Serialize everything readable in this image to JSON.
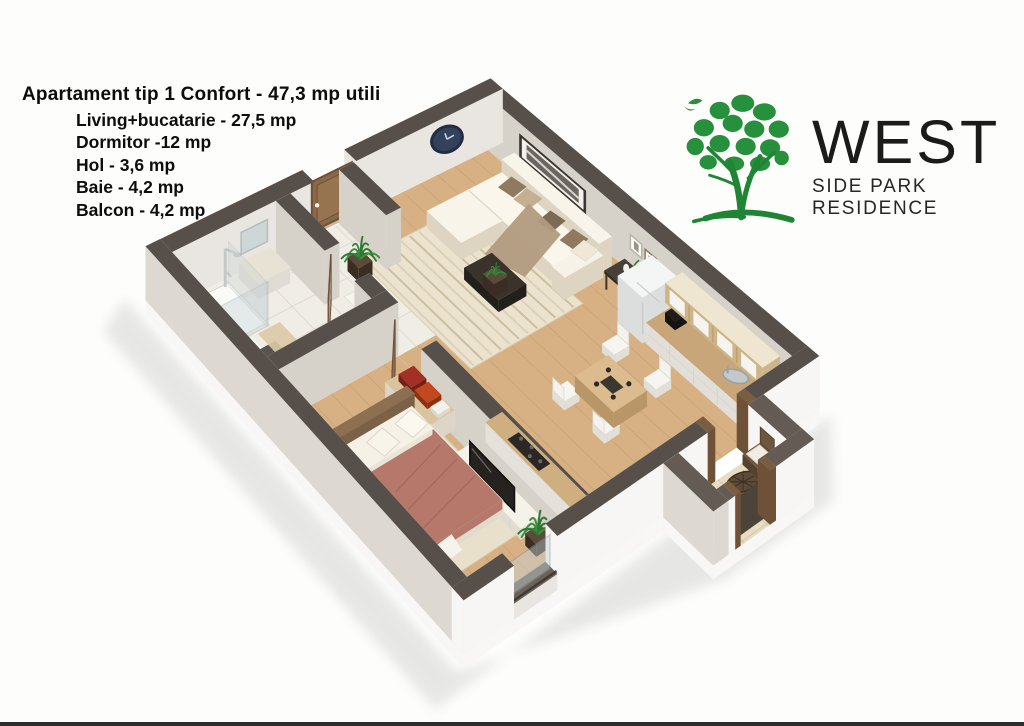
{
  "info": {
    "title": "Apartament tip 1 Confort - 47,3 mp utili",
    "rooms": [
      "Living+bucatarie - 27,5 mp",
      "Dormitor -12 mp",
      "Hol - 3,6 mp",
      "Baie - 4,2 mp",
      "Balcon - 4,2 mp"
    ]
  },
  "logo": {
    "name": "WEST",
    "subtitle": "SIDE PARK RESIDENCE",
    "tree_icon": "tree-logo-icon",
    "green": "#27903c"
  },
  "palette": {
    "wallTop": "#57504a",
    "wallTopLight": "#645c54",
    "wallFace": "#e9e6e1",
    "wallFaceDark": "#d6d2ca",
    "wallExt": "#f7f6f4",
    "slabA": "#efedea",
    "slabB": "#f8f7f5",
    "wood": "#d7b184",
    "woodLine": "#bb9464",
    "tile": "#f0ede7",
    "tileLine": "#dcd7cd",
    "balconyTile": "#e8dcc4",
    "balconyTileLine": "#d2c3a3",
    "rug": "#ece3cf",
    "rugStripe": "#c9bb9c",
    "sofa": "#f3eee2",
    "sofaShade": "#ddd5c2",
    "pillowA": "#8f7a5f",
    "pillowB": "#c4b091",
    "throwFur": "#b29b80",
    "tableDark": "#332d27",
    "doorWood": "#8a6848",
    "doorWoodDark": "#6f5138",
    "blanket": "#b5786a",
    "blanketDark": "#9c6154",
    "linen": "#f5f1e7",
    "headboard": "#9a7b5c",
    "dresser": "#f0ebe2",
    "dresserTop": "#d9c49e",
    "redA": "#a33026",
    "redB": "#c2491f",
    "tv": "#25221f",
    "cabinetWood": "#e2c99e",
    "cabinetFace": "#f3f1ed",
    "counter": "#c8a67a",
    "fridge": "#eef0ef",
    "steel": "#c3c8ca",
    "cooktop": "#2a2724",
    "green1": "#3f8f3f",
    "green2": "#2e7a33",
    "pot": "#4a3c30",
    "wicker": "#6d583f",
    "wickerDark": "#54422f",
    "cushion": "#f1ede3",
    "glass": "#c8d4d6",
    "clockNavy": "#32415c",
    "clockRim": "#222d42",
    "shadow": "#2a2a2a"
  }
}
